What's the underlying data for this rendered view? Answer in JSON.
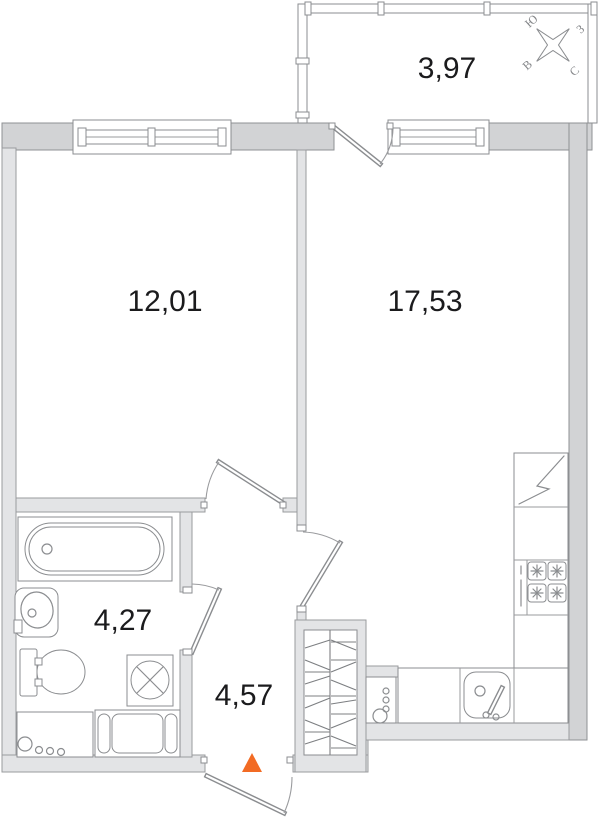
{
  "plan": {
    "rooms": [
      {
        "name": "balcony",
        "area": "3,97"
      },
      {
        "name": "bedroom",
        "area": "12,01"
      },
      {
        "name": "living-kitchen",
        "area": "17,53"
      },
      {
        "name": "bathroom",
        "area": "4,27"
      },
      {
        "name": "hallway",
        "area": "4,57"
      }
    ],
    "compass": {
      "north": "С",
      "south": "Ю",
      "east": "В",
      "west": "З"
    },
    "colors": {
      "wall_dark": "#d2d3d5",
      "wall_light": "#e3e4e6",
      "line": "#8b8d90",
      "text": "#1b1b1d",
      "entrance_marker": "#f26b24"
    },
    "fixtures": [
      "bathtub",
      "washbasin",
      "toilet",
      "washing-machine",
      "bathroom-cabinet",
      "towel-unit",
      "wardrobe",
      "fridge",
      "stove",
      "kitchen-sink",
      "kitchen-counter",
      "boiler-panel",
      "compass-rose",
      "entrance-arrow"
    ]
  }
}
